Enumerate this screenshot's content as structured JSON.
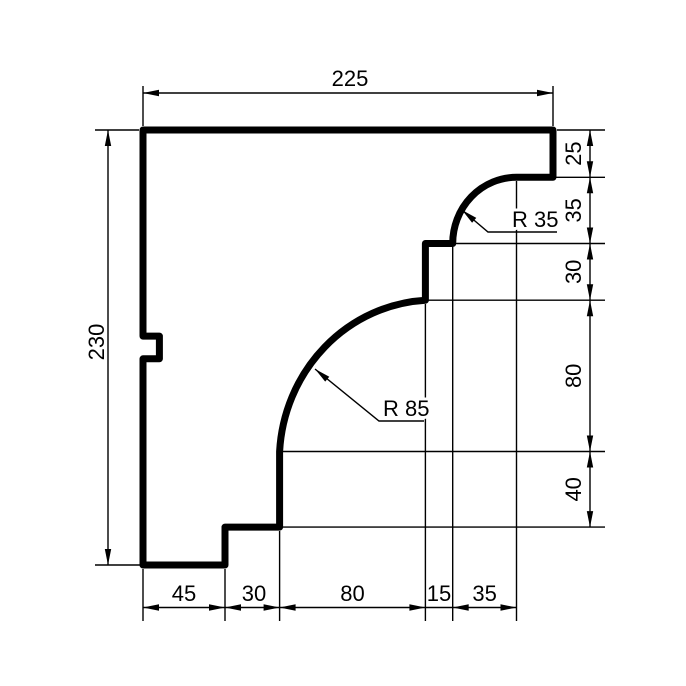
{
  "drawing": {
    "type": "technical-profile-section",
    "colors": {
      "line": "#000000",
      "background": "#ffffff"
    }
  },
  "dims": {
    "top_width": "225",
    "left_height": "230",
    "right": [
      "25",
      "35",
      "30",
      "80",
      "40"
    ],
    "bottom": [
      "45",
      "30",
      "80",
      "15",
      "35"
    ],
    "radius_small": "R 35",
    "radius_large": "R 85"
  }
}
